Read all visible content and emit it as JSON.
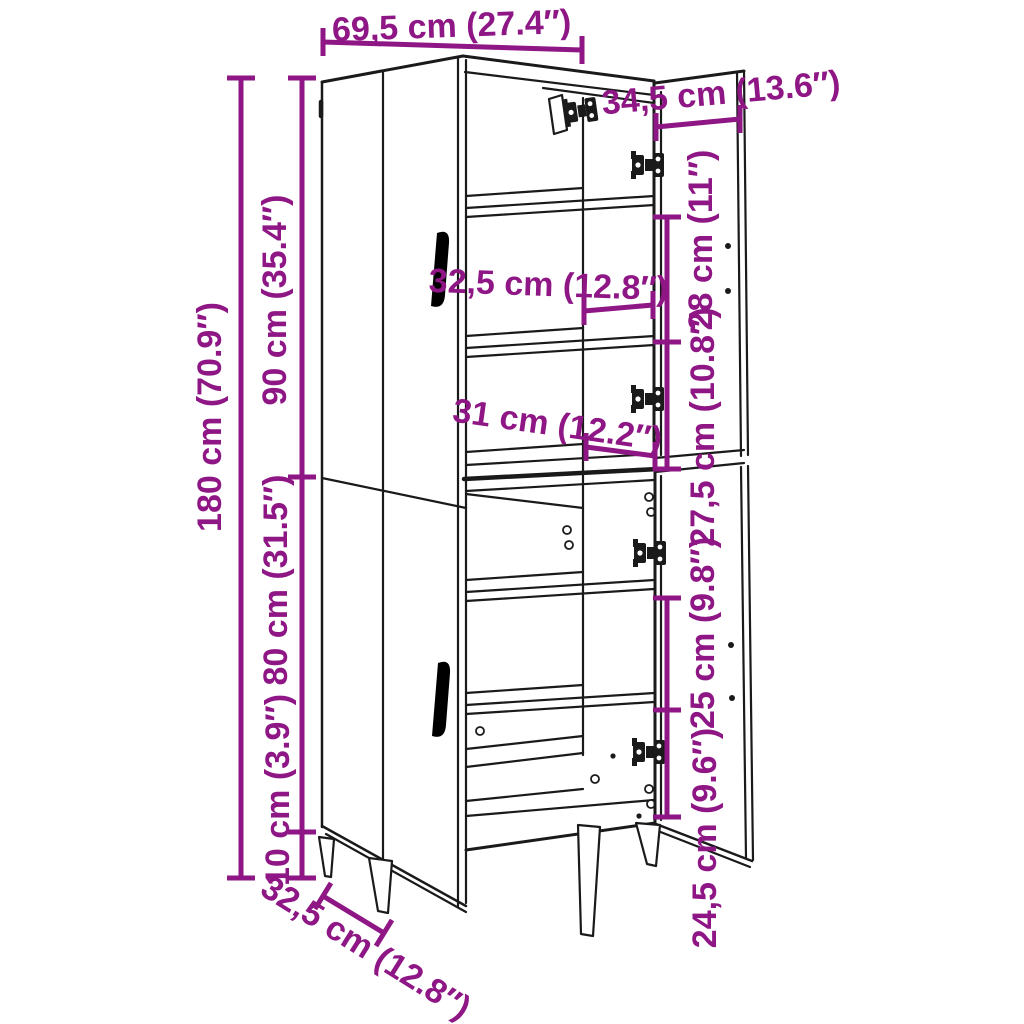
{
  "title": "Cabinet dimension diagram",
  "colors": {
    "accent": "#8E1685",
    "line": "#1A1A1A",
    "background": "#FFFFFF"
  },
  "labels": {
    "width_top": "69,5 cm (27.4″)",
    "depth_top": "34,5 cm (13.6″)",
    "height_total": "180 cm (70.9″)",
    "height_upper": "90 cm (35.4″)",
    "height_lower": "80 cm (31.5″)",
    "leg_height": "10 cm (3.9″)",
    "inner_width_upper": "32,5 cm (12.8″)",
    "inner_width_lower": "31 cm (12.2″)",
    "gap_upper_1": "28 cm (11″)",
    "gap_upper_2": "27,5 cm (10.8″)",
    "gap_lower_1": "25 cm (9.8″)",
    "gap_lower_2": "24,5 cm (9.6″)",
    "depth_bottom": "32,5 cm (12.8″)"
  }
}
